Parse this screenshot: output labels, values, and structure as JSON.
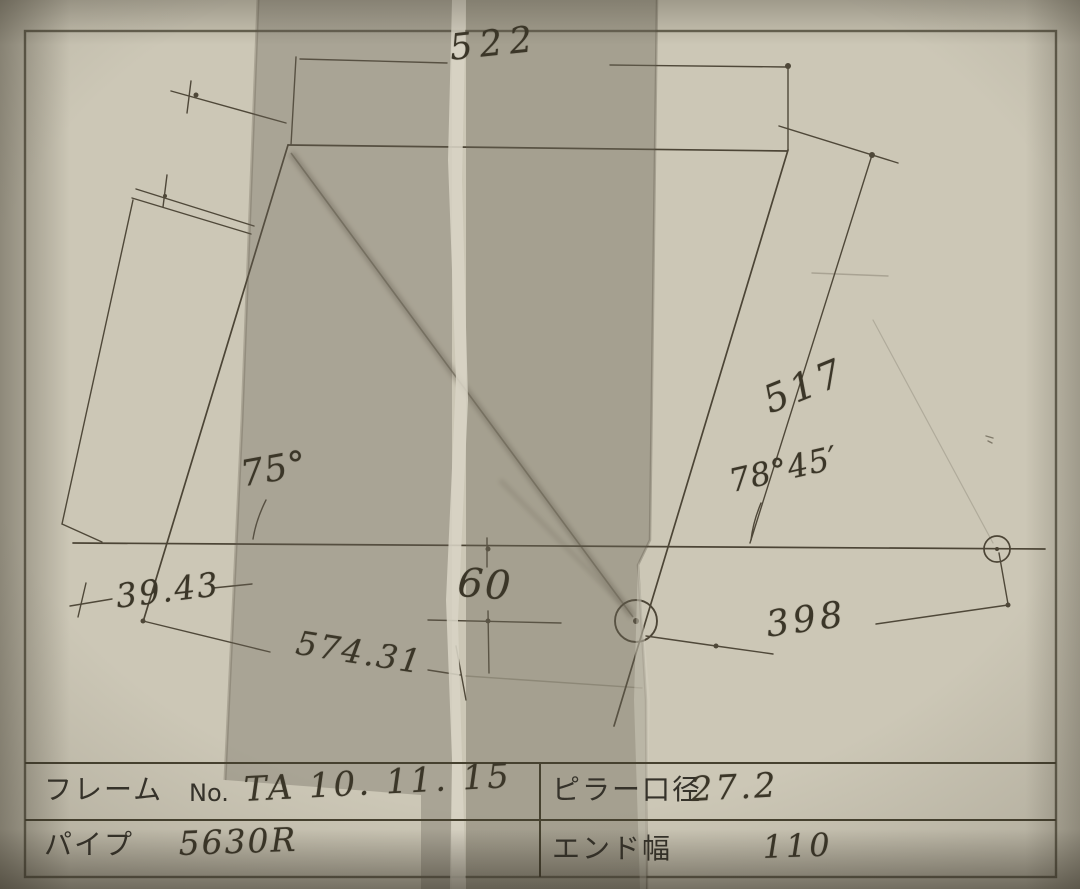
{
  "drawing": {
    "dimensions": {
      "top_tube": "522",
      "tube_length_517": "517",
      "head_angle": "78°45′",
      "seat_angle": "75°",
      "offset_39_43": "39.43",
      "bb_drop": "60",
      "length_574_31": "574.31",
      "stay_length": "398"
    }
  },
  "table": {
    "frame_label": "フレーム",
    "frame_no_label": "No.",
    "frame_value": "TA 10. 11. 15",
    "pipe_label": "パイプ",
    "pipe_value": "5630R",
    "pillar_label": "ピラー口径",
    "pillar_value": "27.2",
    "end_label": "エンド幅",
    "end_value": "110"
  },
  "colors": {
    "paper": "#c9c4b3",
    "ink": "#4c4536",
    "tape": "#9e9886",
    "tear_highlight": "#d8d4c5"
  }
}
